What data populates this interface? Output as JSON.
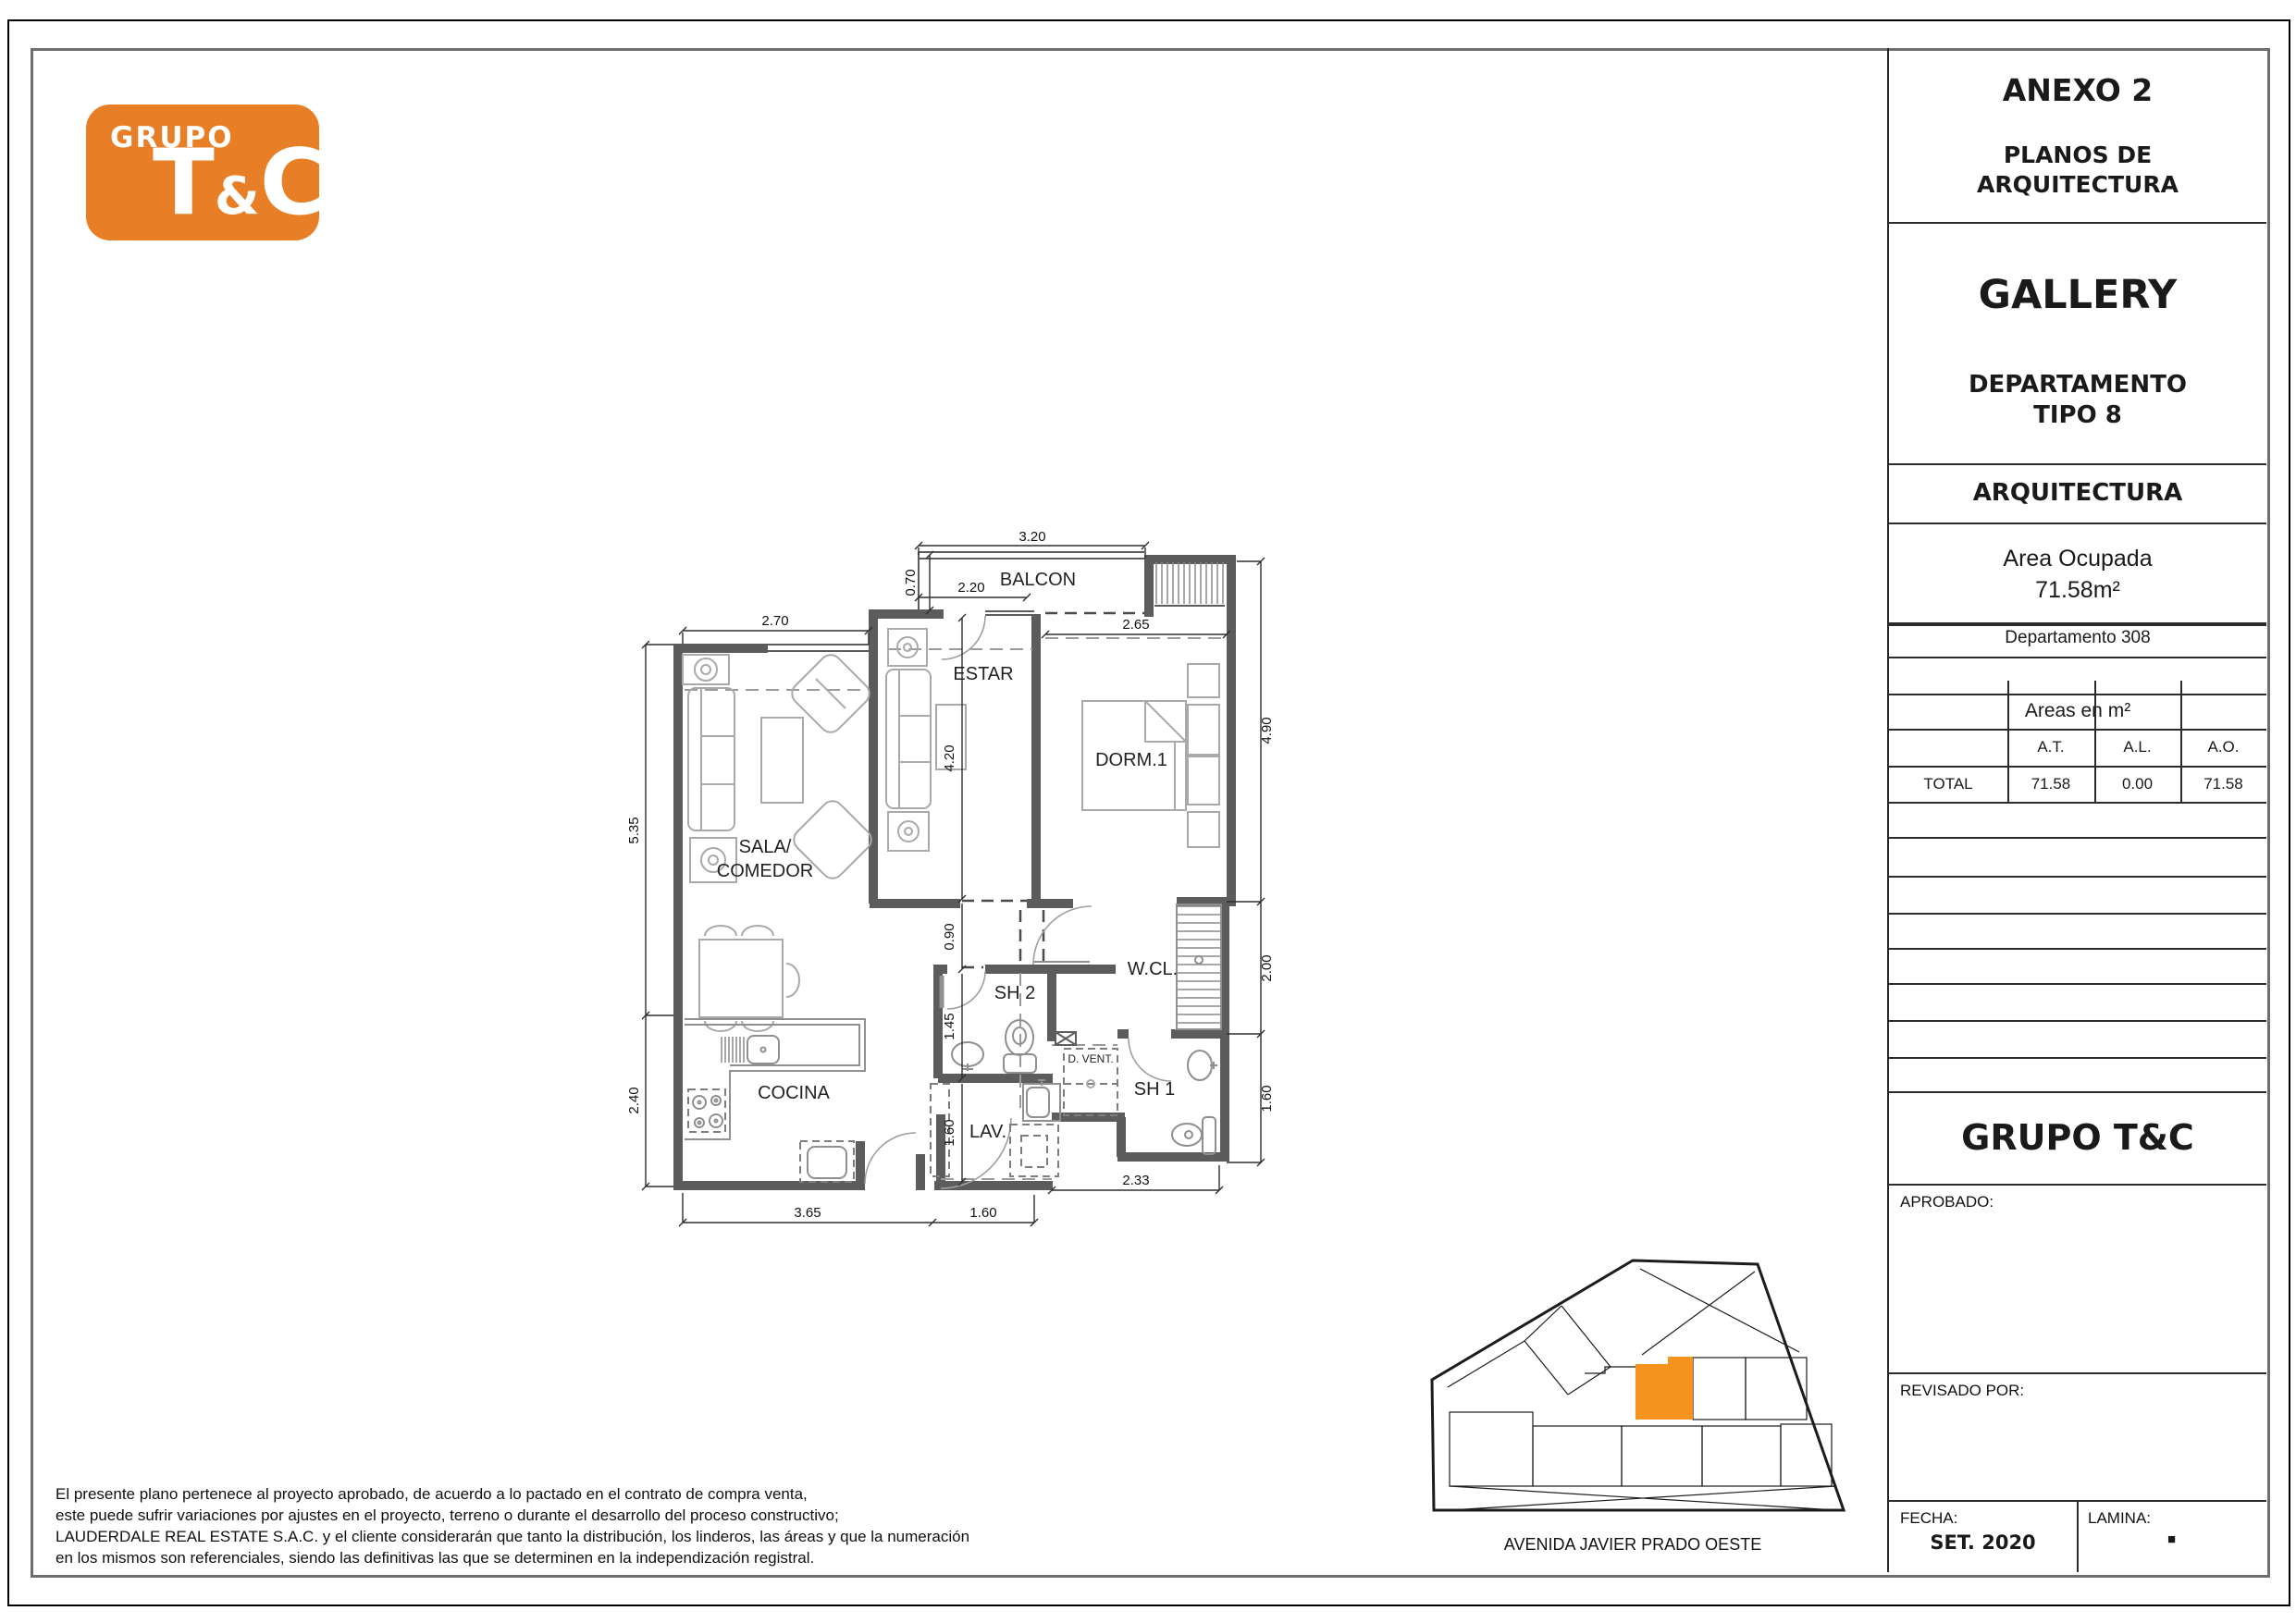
{
  "logo": {
    "top": "GRUPO",
    "t": "T",
    "amp": "&",
    "c": "C"
  },
  "title_block": {
    "anexo": "ANEXO 2",
    "planos_line1": "PLANOS DE",
    "planos_line2": "ARQUITECTURA",
    "project": "GALLERY",
    "tipo_line1": "DEPARTAMENTO",
    "tipo_line2": "TIPO 8",
    "discipline": "ARQUITECTURA",
    "area_label": "Area Ocupada",
    "area_value": "71.58m²",
    "departamento": "Departamento 308",
    "areas_title": "Areas en m²",
    "table": {
      "headers": [
        "A.T.",
        "A.L.",
        "A.O."
      ],
      "row_label": "TOTAL",
      "values": [
        "71.58",
        "0.00",
        "71.58"
      ]
    },
    "company": "GRUPO T&C",
    "aprobado": "APROBADO:",
    "revisado": "REVISADO POR:",
    "fecha_label": "FECHA:",
    "fecha_value": "SET. 2020",
    "lamina_label": "LAMINA:",
    "lamina_value": "■"
  },
  "plan": {
    "rooms": {
      "balcon": "BALCON",
      "estar": "ESTAR",
      "dorm": "DORM.1",
      "sala1": "SALA/",
      "sala2": "COMEDOR",
      "cocina": "COCINA",
      "sh2": "SH 2",
      "wcl": "W.CL.",
      "dvent": "D. VENT.",
      "sh1": "SH 1",
      "lav": "LAV."
    },
    "dims": {
      "balcony_width": "3.20",
      "balcony_depth": "0.70",
      "balcony_door": "2.20",
      "dorm_width": "2.65",
      "sala_width": "2.70",
      "right_upper": "4.90",
      "left_upper": "5.35",
      "estar": "4.20",
      "hall": "0.90",
      "sh2": "1.45",
      "lav": "1.60",
      "left_lower": "2.40",
      "wcl": "2.00",
      "sh1": "1.60",
      "bottom_mid": "2.33",
      "bottom_left": "3.65",
      "bottom_center": "1.60"
    }
  },
  "site": {
    "street": "AVENIDA  JAVIER PRADO OESTE",
    "highlight_color": "#F6921E"
  },
  "disclaimer": {
    "line1": "El presente plano pertenece al proyecto aprobado, de acuerdo a lo pactado en el contrato de compra venta,",
    "line2": "este puede sufrir variaciones por ajustes en el proyecto, terreno o durante el desarrollo del proceso constructivo;",
    "line3": "LAUDERDALE REAL ESTATE S.A.C. y el cliente considerarán que tanto la distribución, los linderos, las áreas y que la numeración",
    "line4": "en los mismos son referenciales, siendo las definitivas las que se determinen en la independización registral."
  },
  "colors": {
    "logo_orange": "#E87E26",
    "highlight_orange": "#F6921E",
    "wall_gray": "#5C5C5C"
  }
}
